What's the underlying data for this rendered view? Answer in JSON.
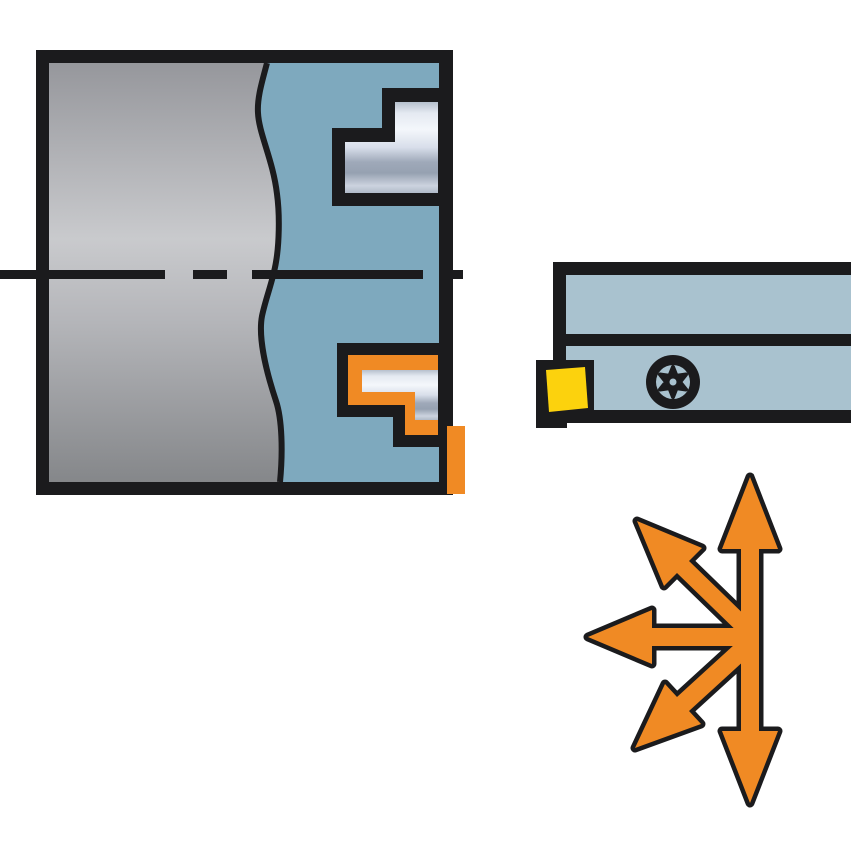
{
  "illustration": {
    "kind": "machining-catalog-diagram",
    "workpiece": {
      "part": "workpiece-cross-section",
      "axis": "dash-dot-centerline",
      "features": [
        "stepped-bore-upper",
        "stepped-groove-lower-with-tool-overlay",
        "protruding-insert-corner"
      ]
    },
    "toolholder": {
      "part": "face-grooving-toolholder",
      "insert": "square-cutting-insert",
      "screw": "torx-clamp-screw"
    },
    "arrows": {
      "meaning": "feed-directions",
      "directions": [
        "up",
        "down",
        "left",
        "up-left",
        "down-left"
      ]
    }
  },
  "colors": {
    "background": "#ffffff",
    "outline": "#1b1b1d",
    "workpiece_blue": "#7ea9be",
    "holder_blue": "#a9c2cf",
    "accent_orange": "#f08a24",
    "insert_yellow": "#fcd20d",
    "steel_gray_top": "#96979c",
    "steel_gray_mid": "#c9cacd",
    "steel_gray_mid2": "#b4b5b9",
    "steel_gray_bottom": "#85878a",
    "silver_0": "#b6c0cd",
    "silver_1": "#e4e9f1",
    "silver_2": "#f4f7fb",
    "silver_3": "#d8deea",
    "silver_4": "#9fa9b9",
    "silver_5": "#96a1b1",
    "silver_6": "#ccd3df",
    "silver_7": "#b0bac8"
  }
}
